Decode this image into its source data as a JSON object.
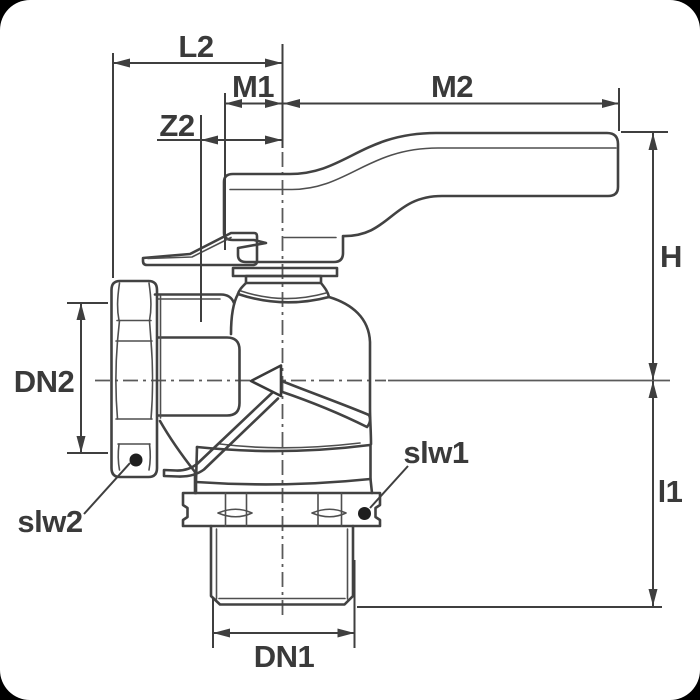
{
  "page": {
    "background_color": "#000000",
    "paper_color": "#ffffff",
    "corner_radius_px": 30
  },
  "drawing": {
    "type": "technical-dimension-drawing",
    "subject": "angle ball valve, side view: lever handle on top, union nut on left port, male threaded bottom port",
    "outline_color": "#424242",
    "dimension_color": "#3f3f3f",
    "text_color": "#3a3a3a",
    "centerline_color": "#5a5a5a",
    "marker_dot_color": "#1f1f1f",
    "flow_arrow_fill": "#ffffff"
  },
  "labels": {
    "l2": "L2",
    "m1": "M1",
    "m2": "M2",
    "z2": "Z2",
    "h": "H",
    "l1": "l1",
    "dn1": "DN1",
    "dn2": "DN2",
    "slw1": "slw1",
    "slw2": "slw2"
  }
}
